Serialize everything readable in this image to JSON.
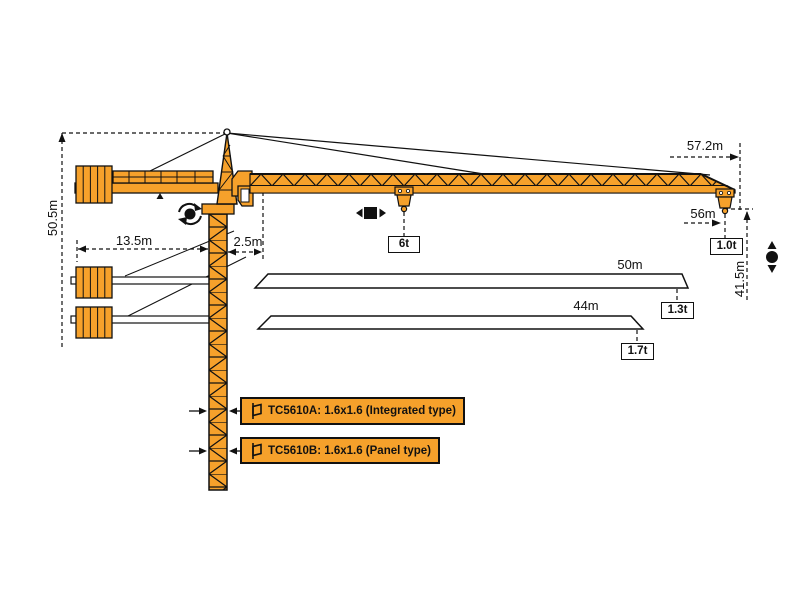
{
  "diagram": {
    "type": "tower-crane-specification-diagram",
    "colors": {
      "crane": "#F6A12B",
      "outline": "#111111",
      "background": "#FFFFFF"
    },
    "dimensions": {
      "overall_height": "50.5m",
      "counterjib_length": "13.5m",
      "min_radius": "2.5m",
      "max_radius": "57.2m",
      "jib_56_radius": "56m",
      "under_hook_height": "41.5m"
    },
    "loads": {
      "mid_span": "6t",
      "tip_56m": "1.0t",
      "tip_50m": "1.3t",
      "tip_44m": "1.7t"
    },
    "jib_variants": {
      "variant_50": "50m",
      "variant_44": "44m"
    },
    "models": [
      {
        "label": "TC5610A: 1.6x1.6 (Integrated type)"
      },
      {
        "label": "TC5610B: 1.6x1.6 (Panel type)"
      }
    ]
  }
}
